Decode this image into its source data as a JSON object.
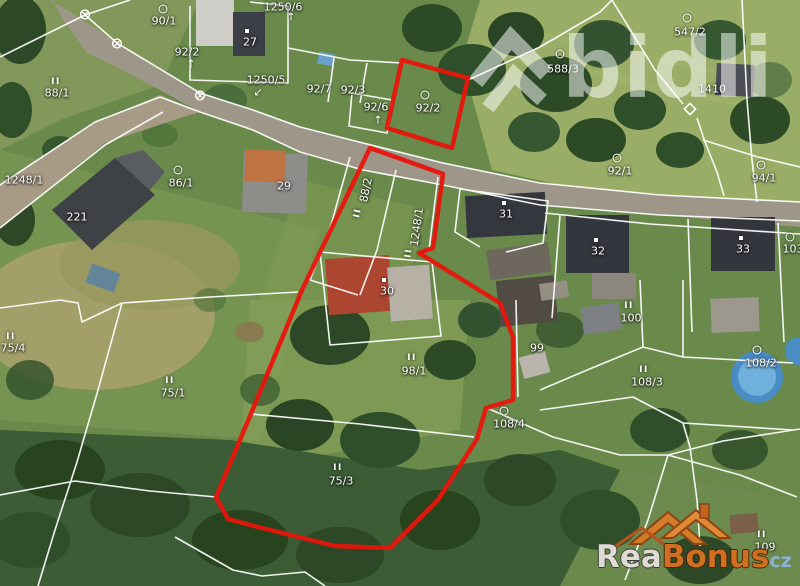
{
  "map": {
    "type": "cadastral-aerial",
    "highlight_color": "#e8150c",
    "boundary_color": "#ffffff",
    "parcels": [
      {
        "label": "1250/6",
        "x": 283,
        "y": 7,
        "sym": "arrow-up",
        "sx": 291,
        "sy": 17
      },
      {
        "label": "90/1",
        "x": 164,
        "y": 21,
        "sym": "circle",
        "sx": 163,
        "sy": 9
      },
      {
        "label": "92/2",
        "x": 187,
        "y": 52,
        "sym": "arrow-up",
        "sx": 191,
        "sy": 64
      },
      {
        "label": "88/1",
        "x": 57,
        "y": 93,
        "sym": "ii",
        "sx": 56,
        "sy": 82
      },
      {
        "label": "1250/5",
        "x": 266,
        "y": 80,
        "sym": "arrow-sw",
        "sx": 258,
        "sy": 92
      },
      {
        "label": "92/7",
        "x": 319,
        "y": 89
      },
      {
        "label": "92/3",
        "x": 353,
        "y": 90
      },
      {
        "label": "92/6",
        "x": 376,
        "y": 107,
        "sym": "arrow-up",
        "sx": 378,
        "sy": 120
      },
      {
        "label": "92/2",
        "x": 428,
        "y": 108,
        "sym": "circle",
        "sx": 425,
        "sy": 95
      },
      {
        "label": "588/3",
        "x": 563,
        "y": 69,
        "sym": "circle",
        "sx": 560,
        "sy": 54
      },
      {
        "label": "547/2",
        "x": 690,
        "y": 32,
        "sym": "circle",
        "sx": 687,
        "sy": 18
      },
      {
        "label": "1410",
        "x": 712,
        "y": 89
      },
      {
        "label": "27",
        "x": 250,
        "y": 42,
        "sym": "dot",
        "sx": 247,
        "sy": 31
      },
      {
        "label": "29",
        "x": 284,
        "y": 186
      },
      {
        "label": "86/1",
        "x": 181,
        "y": 183,
        "sym": "circle",
        "sx": 178,
        "sy": 170
      },
      {
        "label": "221",
        "x": 77,
        "y": 217
      },
      {
        "label": "1248/1",
        "x": 24,
        "y": 180
      },
      {
        "label": "88/2",
        "x": 366,
        "y": 190,
        "rot": -78,
        "sym": "ii",
        "sx": 358,
        "sy": 213,
        "symrot": -78
      },
      {
        "label": "1248/1",
        "x": 417,
        "y": 227,
        "rot": -82,
        "sym": "ii",
        "sx": 409,
        "sy": 253,
        "symrot": -82
      },
      {
        "label": "31",
        "x": 506,
        "y": 214,
        "sym": "dot",
        "sx": 504,
        "sy": 203
      },
      {
        "label": "92/1",
        "x": 620,
        "y": 171,
        "sym": "circle",
        "sx": 617,
        "sy": 158
      },
      {
        "label": "94/1",
        "x": 764,
        "y": 178,
        "sym": "circle",
        "sx": 761,
        "sy": 165
      },
      {
        "label": "32",
        "x": 598,
        "y": 251,
        "sym": "dot",
        "sx": 596,
        "sy": 240
      },
      {
        "label": "33",
        "x": 743,
        "y": 249,
        "sym": "dot",
        "sx": 741,
        "sy": 238
      },
      {
        "label": "103",
        "x": 793,
        "y": 249,
        "sym": "circle",
        "sx": 790,
        "sy": 237
      },
      {
        "label": "100",
        "x": 631,
        "y": 318,
        "sym": "ii",
        "sx": 629,
        "sy": 306
      },
      {
        "label": "99",
        "x": 537,
        "y": 348
      },
      {
        "label": "108/3",
        "x": 647,
        "y": 382,
        "sym": "ii",
        "sx": 644,
        "sy": 370
      },
      {
        "label": "108/2",
        "x": 761,
        "y": 363,
        "sym": "circle",
        "sx": 757,
        "sy": 350
      },
      {
        "label": "108/4",
        "x": 509,
        "y": 424,
        "sym": "circle",
        "sx": 504,
        "sy": 411
      },
      {
        "label": "98/1",
        "x": 414,
        "y": 371,
        "sym": "ii",
        "sx": 412,
        "sy": 358
      },
      {
        "label": "30",
        "x": 387,
        "y": 291,
        "sym": "dot",
        "sx": 384,
        "sy": 280
      },
      {
        "label": "75/4",
        "x": 13,
        "y": 348,
        "sym": "ii",
        "sx": 11,
        "sy": 337
      },
      {
        "label": "75/1",
        "x": 173,
        "y": 393,
        "sym": "ii",
        "sx": 170,
        "sy": 381
      },
      {
        "label": "75/3",
        "x": 341,
        "y": 481,
        "sym": "ii",
        "sx": 338,
        "sy": 468
      },
      {
        "label": "109",
        "x": 765,
        "y": 547,
        "sym": "ii",
        "sx": 762,
        "sy": 535
      }
    ],
    "markers": [
      {
        "type": "crossed-circle",
        "x": 85,
        "y": 15
      },
      {
        "type": "crossed-circle",
        "x": 117,
        "y": 44
      },
      {
        "type": "crossed-circle",
        "x": 200,
        "y": 96
      },
      {
        "type": "diamond",
        "x": 690,
        "y": 111
      }
    ]
  },
  "watermarks": {
    "bidli_text": "bidli",
    "rea": "Rea",
    "bonus": "Bonus",
    "cz": "cz"
  }
}
